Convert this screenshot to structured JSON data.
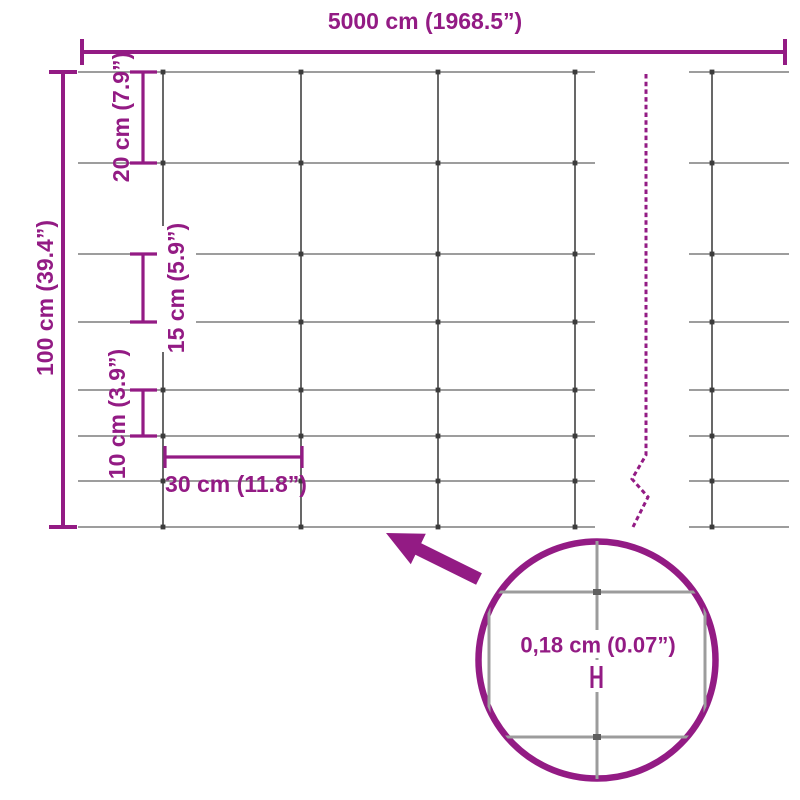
{
  "labels": {
    "total_width": "5000 cm (1968.5”)",
    "total_height": "100 cm (39.4”)",
    "top_row_spacing": "20 cm (7.9”)",
    "middle_row_spacing": "15 cm (5.9”)",
    "bottom_row_spacing": "10 cm (3.9”)",
    "column_spacing": "30 cm (11.8”)",
    "wire_thickness": "0,18 cm (0.07”)"
  },
  "colors": {
    "accent": "#931b84",
    "grid_horizontal": "#7d7d7d",
    "grid_vertical": "#575757",
    "joint": "#3c3c3c",
    "magnifier_line": "#9c9c9c",
    "background": "#ffffff"
  }
}
